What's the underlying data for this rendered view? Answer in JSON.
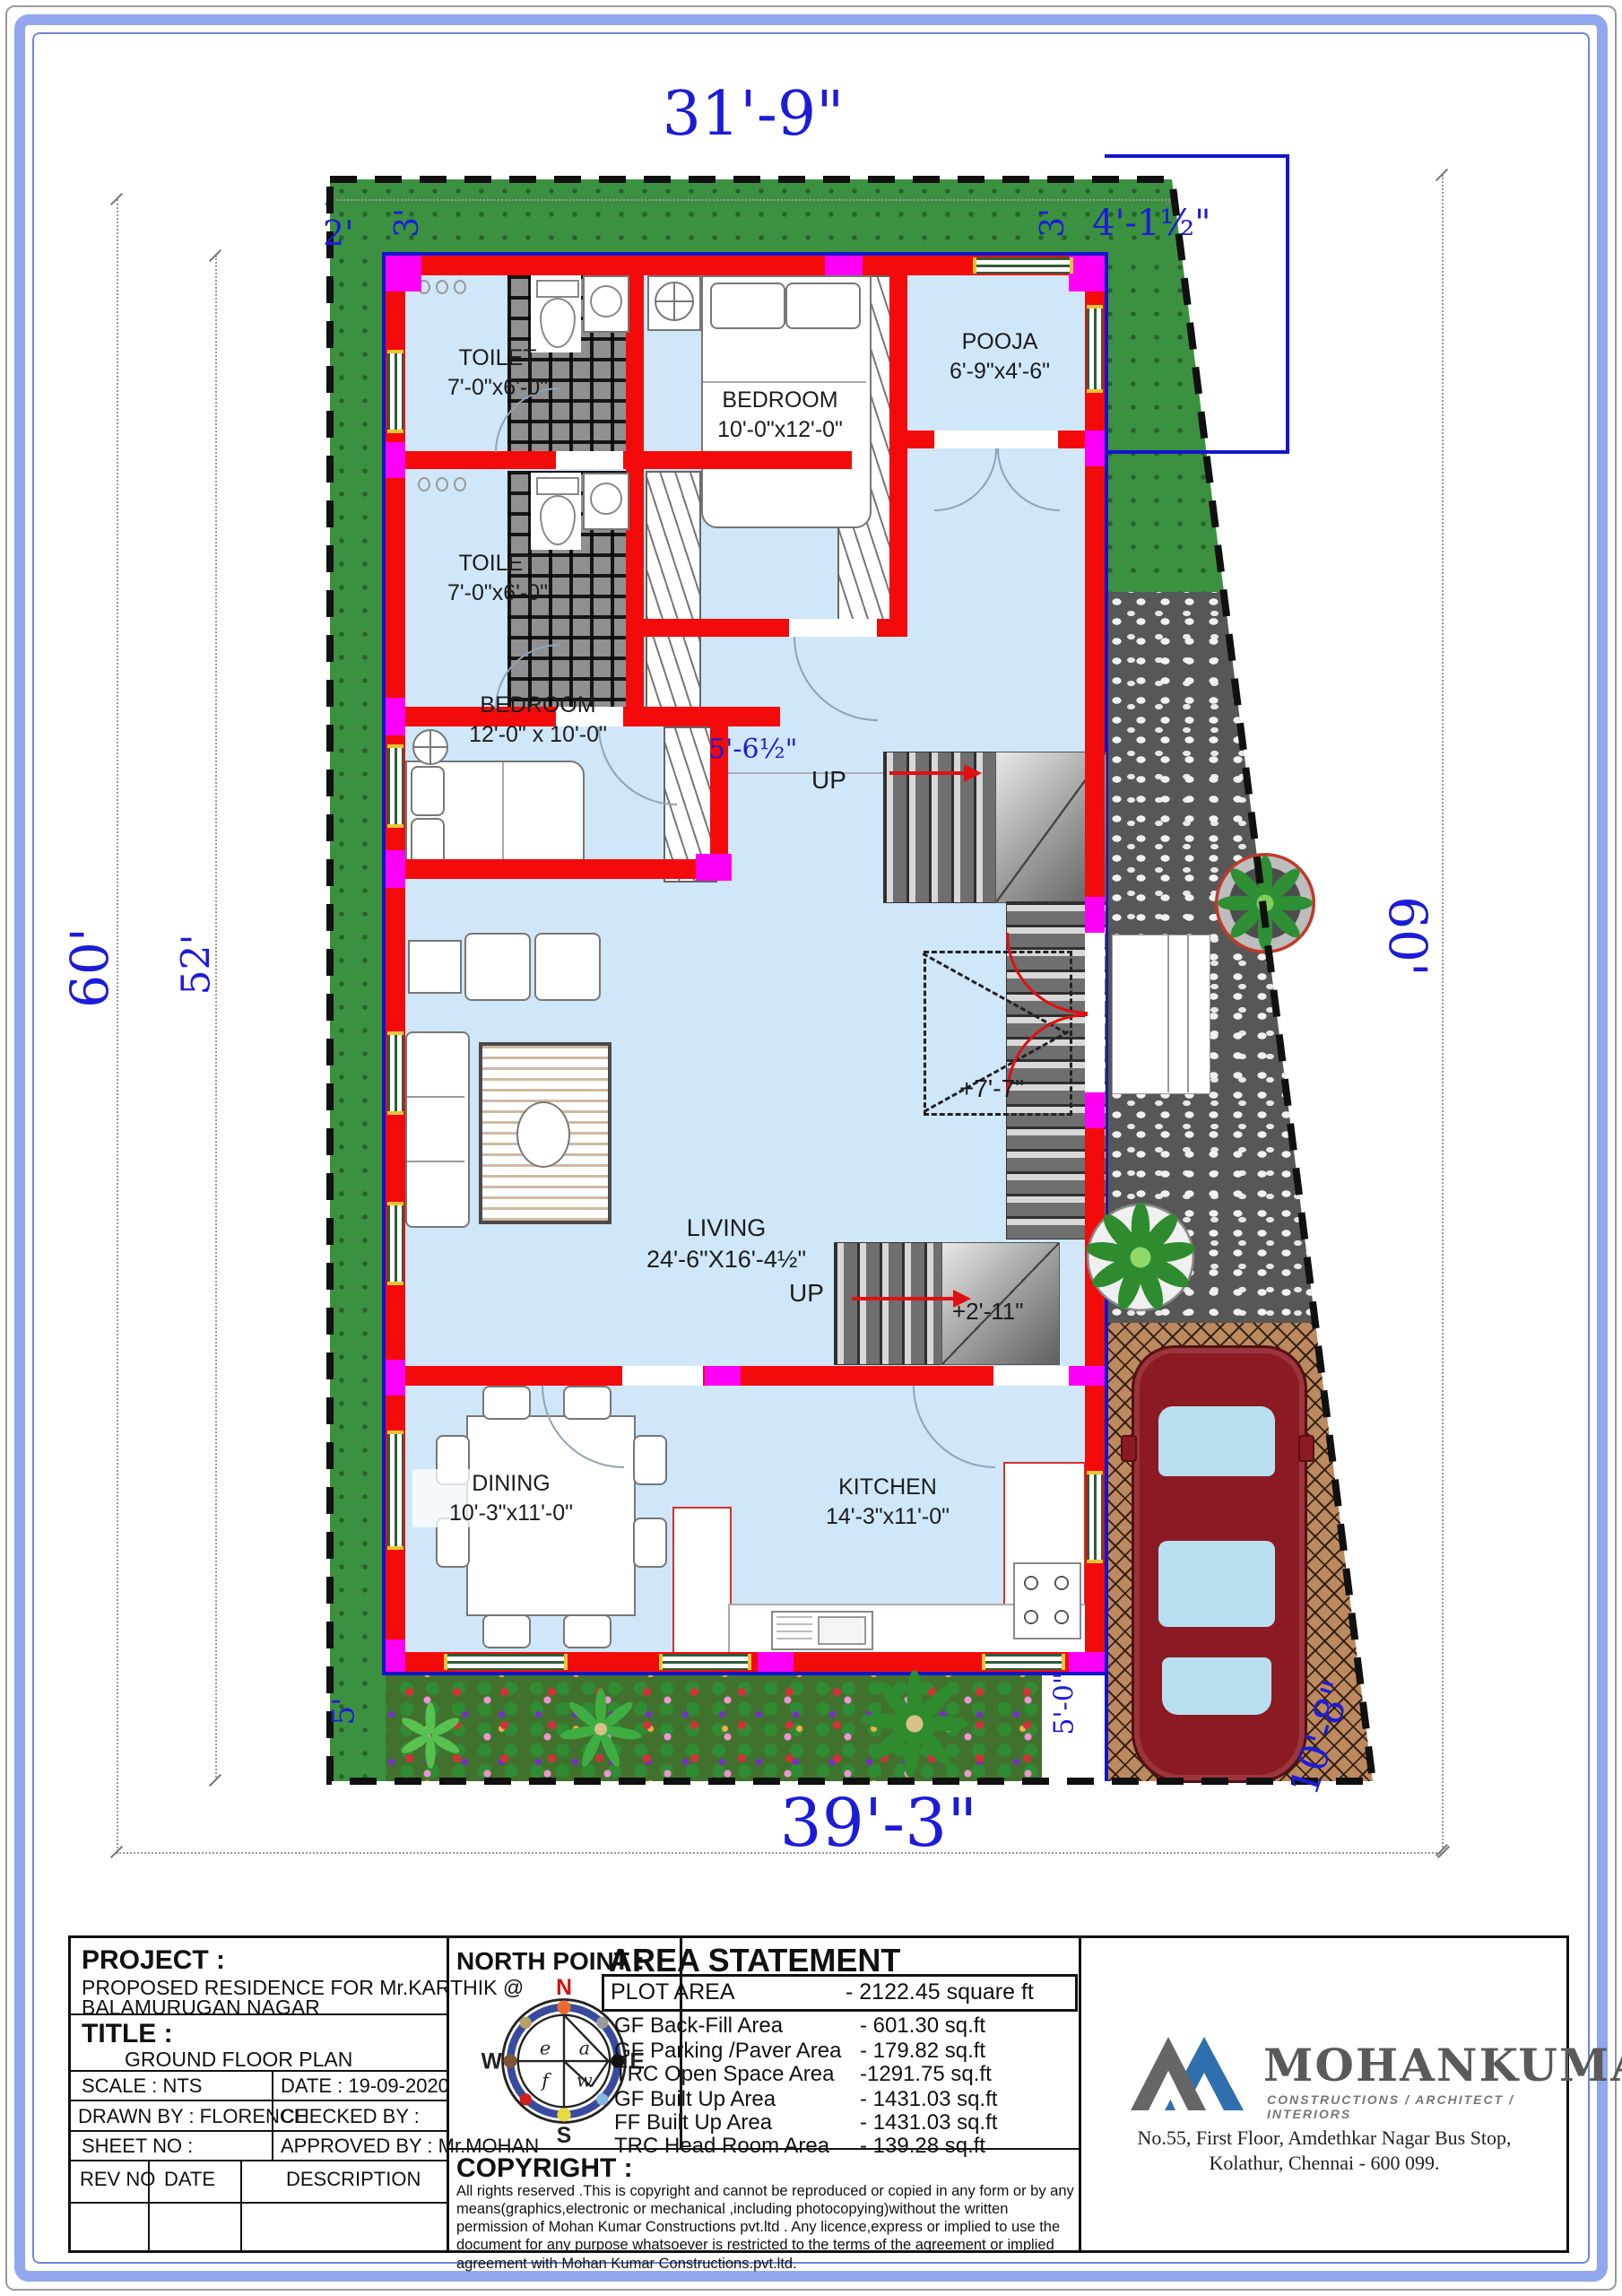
{
  "plan": {
    "dims": {
      "top_width": "31'-9\"",
      "bottom_width": "39'-3\"",
      "left_height": "60'",
      "left_inner_height": "52'",
      "right_height": "60'",
      "top_left_strip": "2'",
      "top_left_setback": "3'",
      "top_right_setback": "3'",
      "top_right_offset": "4'-1½\"",
      "stair_passage": "5'-6½\"",
      "car_park_side": "10'-8\"",
      "bottom_left_setback": "5'",
      "bottom_right_setback": "5'-0\""
    },
    "levels": {
      "landing": "+7'-7\"",
      "mid_landing": "+2'-11\""
    },
    "stairs": {
      "up1": "UP",
      "up2": "UP"
    },
    "rooms": [
      {
        "name": "TOILET",
        "size": "7'-0\"x6'-0\""
      },
      {
        "name": "BEDROOM",
        "size": "10'-0\"x12'-0\""
      },
      {
        "name": "POOJA",
        "size": "6'-9\"x4'-6\""
      },
      {
        "name": "TOILET",
        "size": "7'-0\"x6'-0\""
      },
      {
        "name": "BEDROOM",
        "size": "12'-0\" x 10'-0\""
      },
      {
        "name": "LIVING",
        "size": "24'-6\"X16'-4½\""
      },
      {
        "name": "DINING",
        "size": "10'-3\"x11'-0\""
      },
      {
        "name": "KITCHEN",
        "size": "14'-3\"x11'-0\""
      }
    ]
  },
  "title_block": {
    "project_label": "PROJECT :",
    "project_line1": "PROPOSED RESIDENCE FOR Mr.KARTHIK @",
    "project_line2": "BALAMURUGAN NAGAR",
    "title_label": "TITLE :",
    "title_value": "GROUND FLOOR PLAN",
    "scale": "SCALE  : NTS",
    "date": "DATE  : 19-09-2020",
    "drawn_by": "DRAWN BY  : FLORENCE",
    "checked_by": "CHECKED BY :",
    "sheet_no": "SHEET NO  :",
    "approved_by": "APPROVED BY : Mr.MOHAN",
    "rev_no": "REV NO",
    "rev_date": "DATE",
    "rev_desc": "DESCRIPTION",
    "north_point_label": "NORTH POINT :"
  },
  "north_point": {
    "n": "N",
    "e": "E",
    "s": "S",
    "w": "W",
    "inner_e": "e",
    "inner_a": "a",
    "inner_f": "f",
    "inner_w": "w"
  },
  "area_statement": {
    "title": "AREA STATEMENT",
    "plot_row": {
      "label": "PLOT AREA",
      "value": "- 2122.45 square ft"
    },
    "rows": [
      {
        "label": "GF Back-Fill Area",
        "value": "-  601.30 sq.ft"
      },
      {
        "label": "GF Parking /Paver Area",
        "value": "- 179.82 sq.ft"
      },
      {
        "label": "TRC Open Space Area",
        "value": "-1291.75 sq.ft"
      },
      {
        "label": "GF Built Up Area",
        "value": "- 1431.03 sq.ft"
      },
      {
        "label": "FF Built Up Area",
        "value": "- 1431.03 sq.ft"
      },
      {
        "label": "TRC Head Room Area",
        "value": "-  139.28 sq.ft"
      }
    ]
  },
  "copyright": {
    "label": "COPYRIGHT :",
    "text": " All rights reserved .This is copyright and cannot be reproduced or copied in any form or by any means(graphics,electronic or mechanical ,including photocopying)without the written permission of Mohan Kumar Constructions pvt.ltd . Any licence,express or implied to use the document for any purpose whatsoever is restricted to the terms of the agreement or implied agreement with Mohan Kumar Constructions.pvt.ltd."
  },
  "company": {
    "name": "MOHANKUMAR",
    "tagline": "CONSTRUCTIONS  /  ARCHITECT  /  INTERIORS",
    "address1": "No.55, First Floor, Amdethkar Nagar Bus Stop,",
    "address2": "Kolathur, Chennai - 600 099."
  },
  "colors": {
    "wall_red": "#f30b0b",
    "junction_magenta": "#ff00f6",
    "floor_blue": "#cfe7f8",
    "lawn_green": "#3c9140",
    "dimension_blue": "#1c1cd8",
    "boundary_blue": "#1414cc",
    "logo_gray": "#666666",
    "logo_blue": "#2f6fae",
    "car_maroon": "#8c1a22"
  }
}
